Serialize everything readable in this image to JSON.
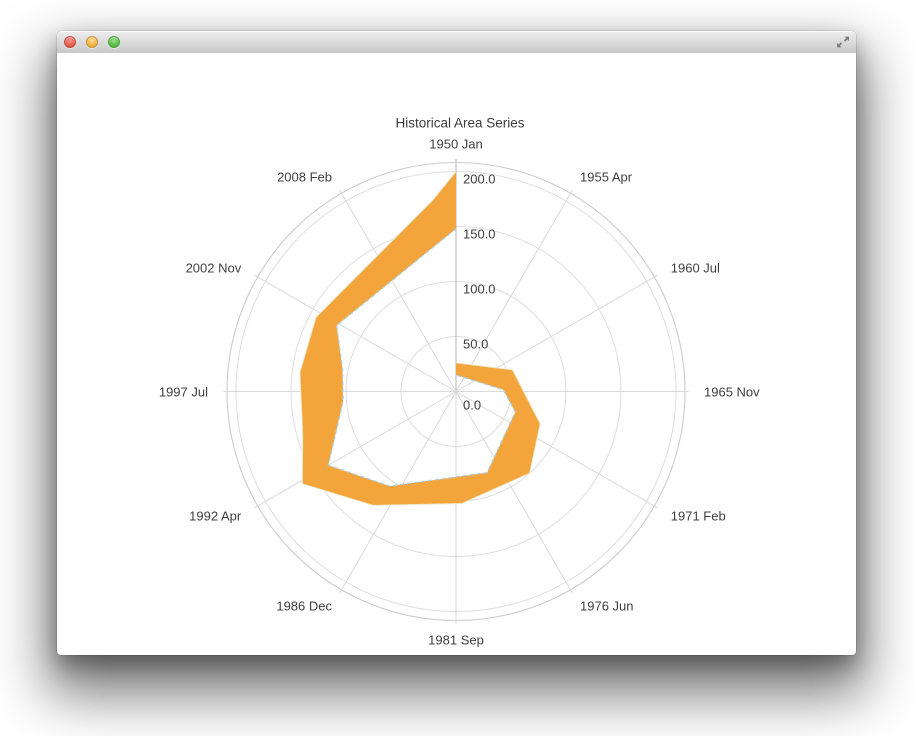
{
  "window": {
    "titlebar_title": "",
    "controls": {
      "close": "close-button",
      "minimize": "minimize-button",
      "zoom": "zoom-button",
      "resize": "diagonal-resize-arrows"
    }
  },
  "chart": {
    "title": "Historical Area Series"
  },
  "chart_data": {
    "type": "area",
    "coordinate_system": "polar",
    "title": "Historical Area Series",
    "angle_axis": {
      "categories": [
        "1950 Jan",
        "1955 Apr",
        "1960 Jul",
        "1965 Nov",
        "1971 Feb",
        "1976 Jun",
        "1981 Sep",
        "1986 Dec",
        "1992 Apr",
        "1997 Jul",
        "2002 Nov",
        "2008 Feb"
      ],
      "degrees_between_categories": 30,
      "start_position": "top",
      "direction": "clockwise"
    },
    "radial_axis": {
      "tick_labels": [
        "0.0",
        "50.0",
        "100.0",
        "150.0",
        "200.0"
      ],
      "tick_values": [
        0,
        50,
        100,
        150,
        200
      ],
      "min": 0,
      "max": 200,
      "outer_boundary_value": 208
    },
    "grid": {
      "rings_at": [
        50,
        100,
        150,
        200
      ],
      "spoke_count": 12,
      "gridlines_on": true
    },
    "legend": {
      "visible": false
    },
    "series": [
      {
        "name": "Historical Area Series",
        "geometry": "closed spiral band; outer boundary listed clockwise from top (0°), inner boundary listed from 360° back to 0°; value = radius in axis units",
        "band_outer": [
          [
            0,
            26
          ],
          [
            69,
            55
          ],
          [
            111,
            82
          ],
          [
            138,
            100
          ],
          [
            177,
            102
          ],
          [
            216,
            128
          ],
          [
            239,
            163
          ],
          [
            254,
            145
          ],
          [
            277,
            143
          ],
          [
            298,
            144
          ],
          [
            353,
            175
          ],
          [
            360,
            200
          ]
        ],
        "band_inner": [
          [
            360,
            148
          ],
          [
            299,
            124
          ],
          [
            281,
            105
          ],
          [
            265,
            103
          ],
          [
            240,
            134
          ],
          [
            215,
            105
          ],
          [
            159,
            79
          ],
          [
            109,
            57
          ],
          [
            88,
            43
          ],
          [
            0,
            15
          ]
        ]
      }
    ]
  },
  "colors": {
    "area_fill": "#F3A43A",
    "inner_edge_stroke": "#A9D0E6",
    "outer_edge_stroke": "#ECEACD",
    "grid_ring": "#DEDEDE",
    "outer_ring": "#CCCCCC",
    "spoke": "#D9D9D9",
    "value_axis_line": "#C6C6C6",
    "label_text": "#404040",
    "title_text": "#3C3C3C",
    "titlebar_top": "#EEEEEE",
    "titlebar_bottom": "#C8C8C8",
    "traffic_red": "#EC6A5E",
    "traffic_yellow": "#F5BD4F",
    "traffic_green": "#62C554"
  }
}
